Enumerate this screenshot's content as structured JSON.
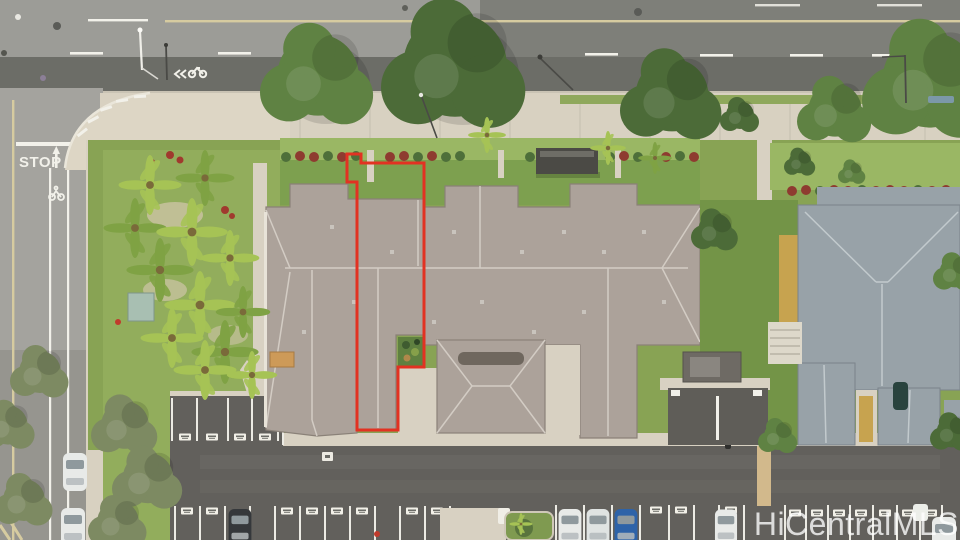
{
  "image": {
    "description": "Aerial drone photo of a townhome complex; one unit traced with a red boundary outline, roads at top and left, parking lot at bottom",
    "width": 960,
    "height": 540
  },
  "watermark": {
    "text": "HiCentralMLS"
  },
  "road_markings": {
    "stop_text": "STOP"
  },
  "colors": {
    "roadLight": "#9c9c97",
    "roadDark": "#6c6d67",
    "roadMid": "#7e7f79",
    "leftStreet": "#a4a39e",
    "curb": "#c9c3b4",
    "sidewalk": "#d8d1c1",
    "plaza": "#ddd6c5",
    "concrete": "#d8d1c2",
    "pathTan": "#d2b98c",
    "grass": "#88a354",
    "grassLight": "#9ab764",
    "lawn": "#92ad5c",
    "treeDark": "#4c6b38",
    "treeMid": "#5f8243",
    "olive": "#7d8a62",
    "palm": "#a6c355",
    "palmDark": "#7fa244",
    "roofMain": "#aca29a",
    "roofRidge": "#d3ccc4",
    "roofEave": "#8a8178",
    "roofRight": "#98a2a8",
    "roofRightRidge": "#c2cacd",
    "wallYellow": "#c7a34f",
    "parking": "#62605c",
    "parkingLight": "#6e6c67",
    "stall": "#ecebe4",
    "hedgeRed": "#8e3b30",
    "hedgeGreen": "#4e6f3a",
    "redOutline": "#e23222",
    "white": "#f2f1ea",
    "yellowLine": "#d6cba0",
    "monument": "#4b4a45",
    "garden": "#5f8040",
    "utilTeal": "#a8bfb2",
    "carWhite": "#e8eae8",
    "carBlue": "#2e63a8",
    "carDark": "#35383b",
    "enclosure": "#6e6a64",
    "porch": "#cd9a58",
    "driveway": "#5f5d58",
    "watermark": "rgba(255,255,255,0.78)"
  }
}
